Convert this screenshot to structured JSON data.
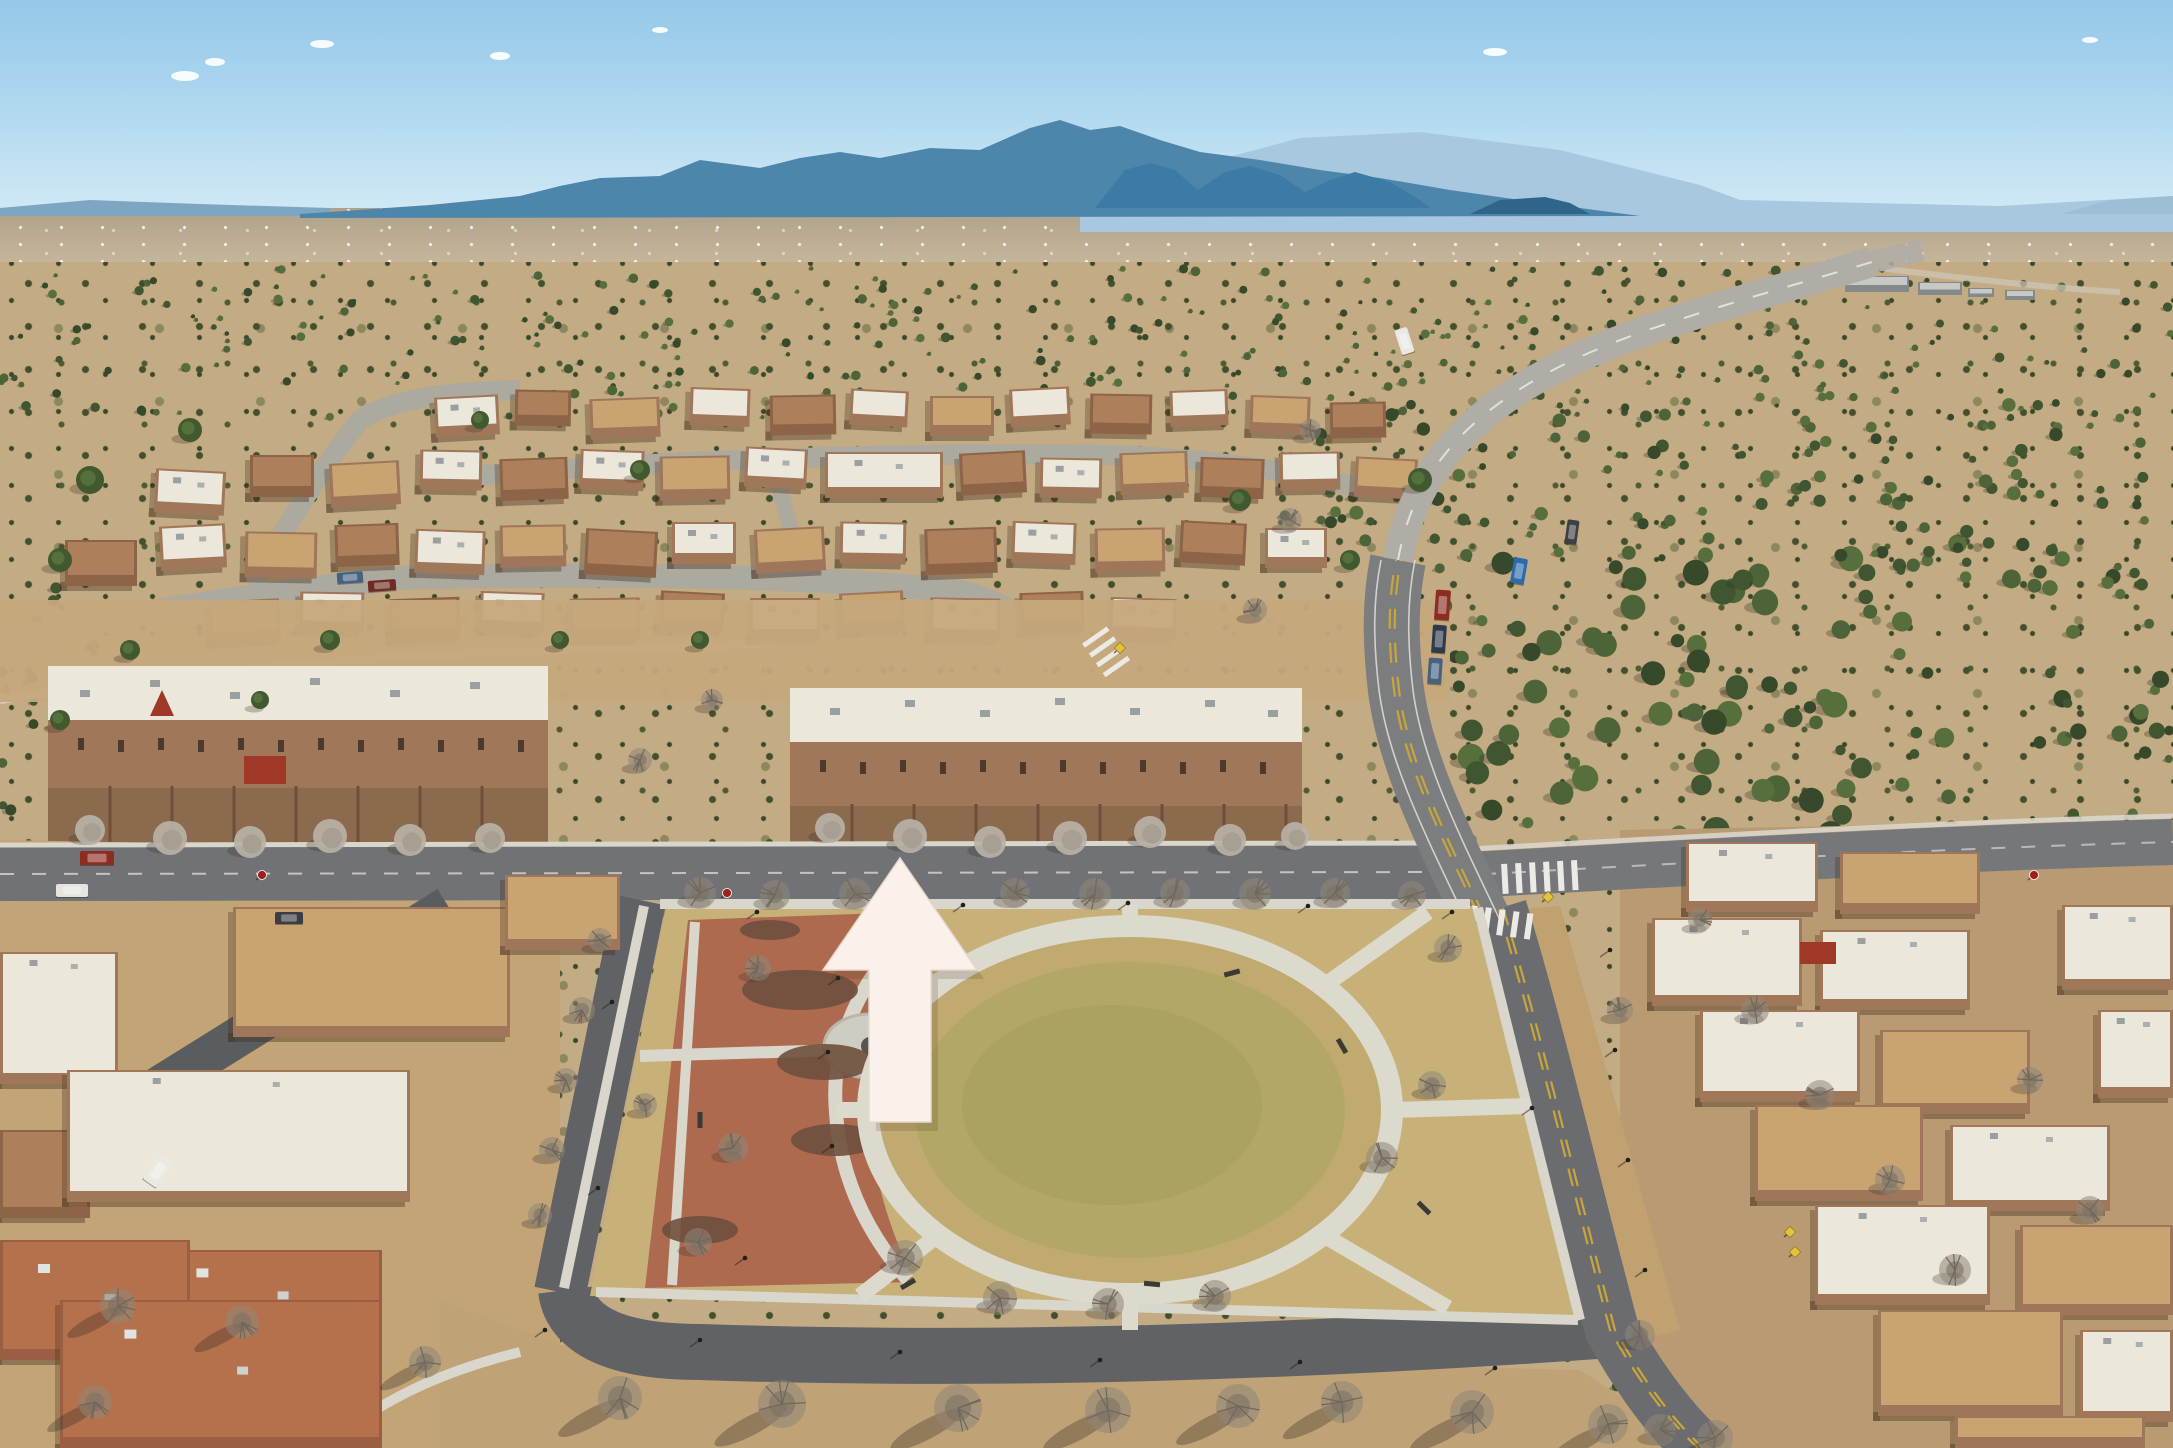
{
  "meta": {
    "type": "aerial-photograph",
    "description": "Drone aerial photo of a high-desert pueblo-style master-planned community: distant blue mountain ranges, juniper scrubland, winding roads, flat-roofed adobe homes and townhomes, a circular neighborhood park with terracotta plaza, and a large cream arrow overlay pointing north at a townhome row.",
    "overlay_note": "No text, labels or watermark appear in the image; the only annotation is a cream upward arrow."
  },
  "palette": {
    "sky_top": "#95c8e9",
    "sky_horizon": "#d8ecf7",
    "mountain_haze": "#a7c8de",
    "mountain_main": "#4e86ab",
    "mountain_foothill": "#3d7ba7",
    "mountain_mesa": "#2f6589",
    "mountain_far_right": "#9dbfd6",
    "mountain_far_left": "#7ca6c2",
    "plain": "#bfb096",
    "desert": "#c3ab83",
    "scrub_green": "#42502e",
    "dirt_field": "#c6a87c",
    "park_ground": "#c8b179",
    "park_ring_grass": "#c0aa70",
    "park_grass_mid": "#b2a765",
    "park_grass_center": "#a9a05f",
    "plaza_brick": "#ad6a4e",
    "concrete": "#d9d6cb",
    "road_light": "#b0ada6",
    "road_mid": "#77797a",
    "road_dark": "#606265",
    "alley": "#5a5d60",
    "lane_yellow": "#c9a53a",
    "lane_white": "#e9e7e1",
    "roof_white": "#ebe7db",
    "roof_tan": "#c9a472",
    "roof_adobe": "#ad7f5a",
    "roof_brown": "#b5714b",
    "wall_adobe": "#a1775a",
    "wall_dark": "#8d6448",
    "courtyard": "#8c6a4e",
    "wall_line": "#6e4f3a",
    "tree_bare": "#8f8679",
    "tree_silver": "#b9b2a7",
    "tree_green": "#41592f",
    "accent_red": "#a03827",
    "sign_red": "#a11f1a",
    "sign_yellow": "#e3c23c",
    "arrow_fill": "#f9f1ea",
    "arrow_edge": "#e8d9cf"
  },
  "scene": {
    "houses_upper": [
      [
        435,
        396,
        64,
        40,
        "w"
      ],
      [
        515,
        390,
        56,
        36,
        "a"
      ],
      [
        590,
        398,
        70,
        40,
        "t"
      ],
      [
        690,
        388,
        60,
        38,
        "w"
      ],
      [
        770,
        395,
        66,
        40,
        "a"
      ],
      [
        850,
        390,
        58,
        36,
        "w"
      ],
      [
        930,
        396,
        64,
        40,
        "t"
      ],
      [
        1010,
        388,
        60,
        38,
        "w"
      ],
      [
        1090,
        394,
        62,
        40,
        "a"
      ],
      [
        1170,
        390,
        58,
        36,
        "w"
      ],
      [
        1250,
        396,
        60,
        38,
        "t"
      ],
      [
        1330,
        402,
        56,
        36,
        "a"
      ],
      [
        155,
        470,
        70,
        44,
        "w"
      ],
      [
        250,
        455,
        64,
        42,
        "a"
      ],
      [
        330,
        462,
        70,
        44,
        "t"
      ],
      [
        420,
        450,
        62,
        40,
        "w"
      ],
      [
        500,
        458,
        68,
        42,
        "a"
      ],
      [
        580,
        450,
        64,
        40,
        "w"
      ],
      [
        660,
        456,
        70,
        44,
        "t"
      ],
      [
        745,
        448,
        62,
        40,
        "w"
      ],
      [
        825,
        452,
        118,
        46,
        "w"
      ],
      [
        960,
        452,
        66,
        42,
        "a"
      ],
      [
        1040,
        458,
        62,
        40,
        "w"
      ],
      [
        1120,
        452,
        68,
        42,
        "t"
      ],
      [
        1200,
        458,
        64,
        40,
        "a"
      ],
      [
        1280,
        452,
        60,
        38,
        "w"
      ],
      [
        1355,
        458,
        62,
        40,
        "t"
      ],
      [
        65,
        540,
        72,
        46,
        "a"
      ],
      [
        160,
        525,
        66,
        44,
        "w"
      ],
      [
        245,
        532,
        72,
        46,
        "t"
      ],
      [
        335,
        524,
        64,
        42,
        "a"
      ],
      [
        415,
        530,
        70,
        44,
        "w"
      ],
      [
        500,
        525,
        66,
        42,
        "t"
      ],
      [
        585,
        530,
        72,
        46,
        "a"
      ],
      [
        672,
        522,
        64,
        42,
        "w"
      ],
      [
        755,
        528,
        70,
        44,
        "t"
      ],
      [
        840,
        522,
        66,
        42,
        "w"
      ],
      [
        925,
        528,
        72,
        46,
        "a"
      ],
      [
        1012,
        522,
        64,
        42,
        "w"
      ],
      [
        1095,
        528,
        70,
        44,
        "t"
      ],
      [
        1180,
        522,
        66,
        42,
        "a"
      ],
      [
        1265,
        528,
        62,
        40,
        "w"
      ],
      [
        210,
        600,
        70,
        42,
        "t"
      ],
      [
        300,
        592,
        64,
        40,
        "w"
      ],
      [
        390,
        598,
        70,
        42,
        "a"
      ],
      [
        480,
        592,
        64,
        40,
        "w"
      ],
      [
        570,
        598,
        70,
        42,
        "t"
      ],
      [
        660,
        592,
        64,
        40,
        "a"
      ],
      [
        750,
        598,
        70,
        42,
        "w"
      ],
      [
        840,
        592,
        64,
        40,
        "t"
      ],
      [
        930,
        598,
        70,
        42,
        "w"
      ],
      [
        1020,
        592,
        64,
        40,
        "a"
      ],
      [
        1110,
        598,
        66,
        40,
        "w"
      ]
    ],
    "houses_left": [
      [
        233,
        907,
        277,
        130,
        "t"
      ],
      [
        0,
        952,
        118,
        132,
        "w"
      ],
      [
        505,
        875,
        115,
        75,
        "t"
      ],
      [
        0,
        1130,
        90,
        88,
        "a"
      ],
      [
        67,
        1070,
        343,
        132,
        "w"
      ],
      [
        150,
        1250,
        232,
        92,
        "b"
      ],
      [
        0,
        1240,
        190,
        120,
        "b"
      ],
      [
        60,
        1300,
        322,
        148,
        "b"
      ]
    ],
    "houses_right": [
      [
        1686,
        842,
        132,
        70,
        "w"
      ],
      [
        1840,
        852,
        140,
        62,
        "t"
      ],
      [
        2062,
        905,
        111,
        85,
        "w"
      ],
      [
        1652,
        918,
        150,
        88,
        "w"
      ],
      [
        1820,
        930,
        150,
        80,
        "w"
      ],
      [
        2098,
        1010,
        75,
        88,
        "w"
      ],
      [
        1700,
        1010,
        160,
        92,
        "w"
      ],
      [
        1880,
        1030,
        150,
        84,
        "t"
      ],
      [
        1755,
        1105,
        168,
        96,
        "t"
      ],
      [
        1950,
        1125,
        160,
        86,
        "w"
      ],
      [
        1815,
        1205,
        175,
        100,
        "w"
      ],
      [
        2020,
        1225,
        153,
        90,
        "t"
      ],
      [
        1878,
        1310,
        185,
        106,
        "t"
      ],
      [
        2080,
        1330,
        93,
        92,
        "w"
      ],
      [
        1955,
        1416,
        190,
        32,
        "t"
      ]
    ],
    "distant_buildings": [
      [
        1845,
        276,
        64,
        16
      ],
      [
        1918,
        282,
        44,
        13
      ],
      [
        1968,
        288,
        26,
        9
      ],
      [
        2005,
        290,
        30,
        10
      ]
    ],
    "trees": [
      [
        700,
        893,
        16,
        "b"
      ],
      [
        775,
        895,
        15,
        "b"
      ],
      [
        855,
        894,
        16,
        "b"
      ],
      [
        1015,
        893,
        15,
        "b"
      ],
      [
        1095,
        894,
        16,
        "b"
      ],
      [
        1175,
        893,
        15,
        "b"
      ],
      [
        1255,
        894,
        16,
        "b"
      ],
      [
        1335,
        893,
        15,
        "b"
      ],
      [
        1412,
        895,
        14,
        "b"
      ],
      [
        1448,
        948,
        14,
        "b"
      ],
      [
        1382,
        1158,
        16,
        "b"
      ],
      [
        1432,
        1085,
        14,
        "b"
      ],
      [
        1000,
        1298,
        17,
        "b"
      ],
      [
        1108,
        1304,
        16,
        "b"
      ],
      [
        1215,
        1296,
        16,
        "b"
      ],
      [
        905,
        1258,
        18,
        "b"
      ],
      [
        733,
        1148,
        15,
        "b"
      ],
      [
        698,
        1242,
        14,
        "b"
      ],
      [
        758,
        968,
        13,
        "b"
      ],
      [
        645,
        1105,
        12,
        "b"
      ],
      [
        600,
        940,
        12,
        "b"
      ],
      [
        582,
        1010,
        13,
        "b"
      ],
      [
        566,
        1080,
        12,
        "b"
      ],
      [
        552,
        1150,
        13,
        "b"
      ],
      [
        540,
        1215,
        12,
        "b"
      ],
      [
        620,
        1398,
        22,
        "B"
      ],
      [
        782,
        1404,
        24,
        "B"
      ],
      [
        958,
        1408,
        24,
        "B"
      ],
      [
        1108,
        1410,
        23,
        "B"
      ],
      [
        1238,
        1406,
        22,
        "B"
      ],
      [
        1342,
        1402,
        21,
        "B"
      ],
      [
        1472,
        1412,
        22,
        "B"
      ],
      [
        1608,
        1424,
        20,
        "B"
      ],
      [
        1715,
        1438,
        18,
        "B"
      ],
      [
        118,
        1306,
        18,
        "B"
      ],
      [
        242,
        1322,
        17,
        "B"
      ],
      [
        425,
        1362,
        16,
        "B"
      ],
      [
        95,
        1402,
        17,
        "B"
      ],
      [
        90,
        830,
        15,
        "s"
      ],
      [
        170,
        838,
        17,
        "s"
      ],
      [
        250,
        842,
        16,
        "s"
      ],
      [
        330,
        836,
        17,
        "s"
      ],
      [
        410,
        840,
        16,
        "s"
      ],
      [
        490,
        838,
        15,
        "s"
      ],
      [
        830,
        828,
        15,
        "s"
      ],
      [
        910,
        836,
        17,
        "s"
      ],
      [
        990,
        842,
        16,
        "s"
      ],
      [
        1070,
        838,
        17,
        "s"
      ],
      [
        1150,
        832,
        16,
        "s"
      ],
      [
        1230,
        840,
        16,
        "s"
      ],
      [
        1295,
        836,
        14,
        "s"
      ],
      [
        640,
        760,
        12,
        "b"
      ],
      [
        712,
        700,
        11,
        "b"
      ],
      [
        1755,
        1010,
        14,
        "b"
      ],
      [
        1820,
        1095,
        15,
        "b"
      ],
      [
        1890,
        1180,
        15,
        "b"
      ],
      [
        1955,
        1270,
        16,
        "b"
      ],
      [
        2030,
        1080,
        13,
        "b"
      ],
      [
        1700,
        920,
        12,
        "b"
      ],
      [
        2090,
        1210,
        14,
        "b"
      ],
      [
        1640,
        1335,
        15,
        "b"
      ],
      [
        1660,
        1430,
        16,
        "b"
      ],
      [
        1620,
        1010,
        13,
        "b"
      ],
      [
        1290,
        520,
        12,
        "b"
      ],
      [
        1310,
        430,
        11,
        "b"
      ],
      [
        1255,
        610,
        12,
        "b"
      ],
      [
        190,
        430,
        12,
        "g"
      ],
      [
        90,
        480,
        14,
        "g"
      ],
      [
        60,
        560,
        12,
        "g"
      ],
      [
        640,
        470,
        10,
        "g"
      ],
      [
        1240,
        500,
        11,
        "g"
      ],
      [
        1420,
        480,
        12,
        "g"
      ],
      [
        330,
        640,
        10,
        "g"
      ],
      [
        560,
        640,
        9,
        "g"
      ],
      [
        480,
        420,
        9,
        "g"
      ],
      [
        1350,
        560,
        10,
        "g"
      ],
      [
        700,
        640,
        9,
        "g"
      ],
      [
        130,
        650,
        10,
        "g"
      ],
      [
        260,
        700,
        9,
        "g"
      ],
      [
        60,
        720,
        10,
        "g"
      ]
    ],
    "scrub_regions": [
      {
        "x": 1440,
        "y": 555,
        "w": 430,
        "h": 300,
        "n": 80,
        "rmin": 5,
        "rmax": 14
      },
      {
        "x": 1870,
        "y": 540,
        "w": 300,
        "h": 290,
        "n": 45,
        "rmin": 4,
        "rmax": 10
      },
      {
        "x": 0,
        "y": 268,
        "w": 2173,
        "h": 150,
        "n": 320,
        "rmin": 2,
        "rmax": 5
      },
      {
        "x": 1250,
        "y": 400,
        "w": 900,
        "h": 170,
        "n": 130,
        "rmin": 3,
        "rmax": 7
      },
      {
        "x": 460,
        "y": 1385,
        "w": 1200,
        "h": 60,
        "n": 70,
        "rmin": 2,
        "rmax": 5
      },
      {
        "x": 0,
        "y": 580,
        "w": 140,
        "h": 260,
        "n": 30,
        "rmin": 3,
        "rmax": 6
      }
    ],
    "scrub_colors": [
      "#3f5630",
      "#4c6438",
      "#36492a",
      "#566f3d"
    ],
    "cars": [
      {
        "x": 80,
        "y": 851,
        "w": 34,
        "h": 14,
        "c": "#8d2d21",
        "r": 0
      },
      {
        "x": 56,
        "y": 884,
        "w": 32,
        "h": 13,
        "c": "#e6e4df",
        "r": 0
      },
      {
        "x": 275,
        "y": 912,
        "w": 28,
        "h": 12,
        "c": "#3a3d42",
        "r": 0
      },
      {
        "x": 337,
        "y": 572,
        "w": 26,
        "h": 11,
        "c": "#45627e",
        "r": -4
      },
      {
        "x": 368,
        "y": 580,
        "w": 28,
        "h": 11,
        "c": "#6e2b20",
        "r": -4
      },
      {
        "x": 1435,
        "y": 590,
        "w": 15,
        "h": 30,
        "c": "#8d2d21",
        "r": 4
      },
      {
        "x": 1432,
        "y": 625,
        "w": 14,
        "h": 28,
        "c": "#2e3b4c",
        "r": 4
      },
      {
        "x": 1428,
        "y": 658,
        "w": 14,
        "h": 26,
        "c": "#46627e",
        "r": 4
      },
      {
        "x": 1512,
        "y": 558,
        "w": 14,
        "h": 26,
        "c": "#2e6ca8",
        "r": 10
      },
      {
        "x": 1398,
        "y": 328,
        "w": 13,
        "h": 26,
        "c": "#e9e8e4",
        "r": -18
      },
      {
        "x": 1566,
        "y": 520,
        "w": 12,
        "h": 24,
        "c": "#3c3f44",
        "r": 8
      },
      {
        "x": 150,
        "y": 1156,
        "w": 16,
        "h": 30,
        "c": "#ebe9e4",
        "r": 35
      }
    ],
    "lamps": [
      [
        757,
        912
      ],
      [
        838,
        978
      ],
      [
        828,
        1052
      ],
      [
        832,
        1146
      ],
      [
        745,
        1258
      ],
      [
        963,
        905
      ],
      [
        1128,
        903
      ],
      [
        1308,
        906
      ],
      [
        1452,
        912
      ],
      [
        1532,
        1108
      ],
      [
        612,
        1002
      ],
      [
        598,
        1188
      ],
      [
        700,
        1340
      ],
      [
        900,
        1352
      ],
      [
        1100,
        1360
      ],
      [
        1300,
        1362
      ],
      [
        1495,
        1368
      ],
      [
        545,
        1330
      ],
      [
        1610,
        950
      ],
      [
        1615,
        1050
      ],
      [
        1628,
        1160
      ],
      [
        1645,
        1270
      ]
    ],
    "benches": [
      [
        1232,
        973,
        -15
      ],
      [
        1342,
        1046,
        60
      ],
      [
        1152,
        1284,
        5
      ],
      [
        908,
        1284,
        -30
      ],
      [
        1424,
        1208,
        45
      ],
      [
        700,
        1120,
        90
      ]
    ],
    "signs": [
      {
        "x": 262,
        "y": 875,
        "t": "stop"
      },
      {
        "x": 727,
        "y": 893,
        "t": "stop"
      },
      {
        "x": 2034,
        "y": 875,
        "t": "stop"
      },
      {
        "x": 1548,
        "y": 897,
        "t": "yellow"
      },
      {
        "x": 1795,
        "y": 1252,
        "t": "yellow"
      },
      {
        "x": 1790,
        "y": 1232,
        "t": "yellow"
      },
      {
        "x": 1120,
        "y": 648,
        "t": "yellow"
      }
    ],
    "clouds": [
      [
        185,
        76,
        14,
        5
      ],
      [
        215,
        62,
        10,
        4
      ],
      [
        322,
        44,
        12,
        4
      ],
      [
        500,
        56,
        10,
        4
      ],
      [
        660,
        30,
        8,
        3
      ],
      [
        1495,
        52,
        12,
        4
      ],
      [
        2090,
        40,
        8,
        3
      ]
    ],
    "arrow": {
      "points": "900,858 977,970 931,970 931,1122 869,1122 869,970 823,970",
      "shadow_dx": 7,
      "shadow_dy": 9
    }
  }
}
